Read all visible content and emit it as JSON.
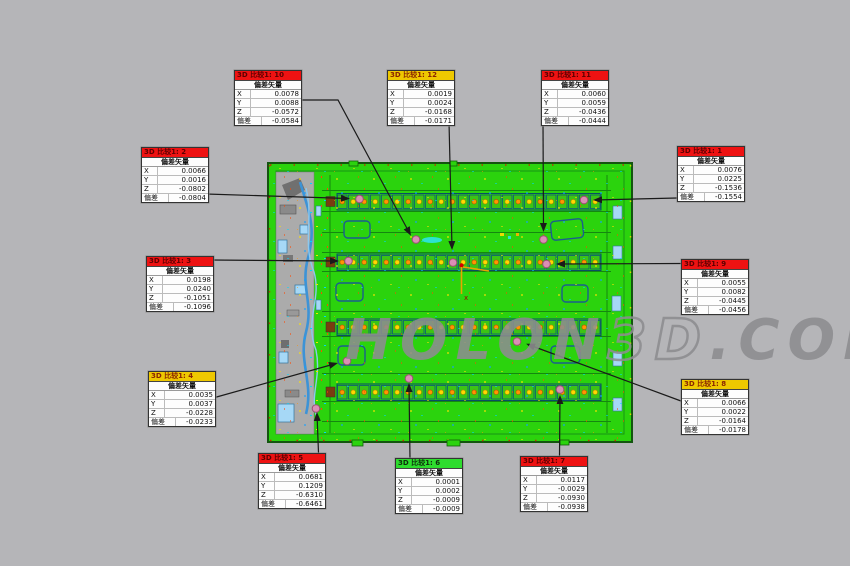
{
  "background": "#b5b5b8",
  "watermark": {
    "part1": "HOLON",
    "part2": "3D",
    "part3": ".COM"
  },
  "labels": {
    "vector_header": "偏差矢量",
    "x": "X",
    "y": "Y",
    "z": "Z",
    "deviation": "偏差"
  },
  "axis": {
    "x_label": "x"
  },
  "colors": {
    "model_green": "#2bd30d",
    "marker_pink": "#da8fb4",
    "fail_red": "#ee1212",
    "warn_yellow": "#eec800",
    "pass_green": "#2edc2e"
  },
  "callouts": [
    {
      "title": "3D 比较1: 10",
      "severity": "red",
      "header_bg": "#ee1212",
      "header_fg": "#5d0000",
      "x": "0.0078",
      "y": "0.0088",
      "z": "-0.0572",
      "deviation": "-0.0584"
    },
    {
      "title": "3D 比较1: 12",
      "severity": "yellow",
      "header_bg": "#eec800",
      "header_fg": "#8a2500",
      "x": "0.0019",
      "y": "0.0024",
      "z": "-0.0168",
      "deviation": "-0.0171"
    },
    {
      "title": "3D 比较1: 11",
      "severity": "red",
      "header_bg": "#ee1212",
      "header_fg": "#5d0000",
      "x": "0.0060",
      "y": "0.0059",
      "z": "-0.0436",
      "deviation": "-0.0444"
    },
    {
      "title": "3D 比较1: 2",
      "severity": "red",
      "header_bg": "#ee1212",
      "header_fg": "#5d0000",
      "x": "0.0066",
      "y": "0.0016",
      "z": "-0.0802",
      "deviation": "-0.0804"
    },
    {
      "title": "3D 比较1: 1",
      "severity": "red",
      "header_bg": "#ee1212",
      "header_fg": "#5d0000",
      "x": "0.0076",
      "y": "0.0225",
      "z": "-0.1536",
      "deviation": "-0.1554"
    },
    {
      "title": "3D 比较1: 3",
      "severity": "red",
      "header_bg": "#ee1212",
      "header_fg": "#5d0000",
      "x": "0.0198",
      "y": "0.0240",
      "z": "-0.1051",
      "deviation": "-0.1096"
    },
    {
      "title": "3D 比较1: 9",
      "severity": "red",
      "header_bg": "#ee1212",
      "header_fg": "#5d0000",
      "x": "0.0055",
      "y": "0.0082",
      "z": "-0.0445",
      "deviation": "-0.0456"
    },
    {
      "title": "3D 比较1: 4",
      "severity": "yellow",
      "header_bg": "#eec800",
      "header_fg": "#8a2500",
      "x": "0.0035",
      "y": "0.0037",
      "z": "-0.0228",
      "deviation": "-0.0233"
    },
    {
      "title": "3D 比较1: 8",
      "severity": "yellow",
      "header_bg": "#eec800",
      "header_fg": "#8a2500",
      "x": "0.0066",
      "y": "0.0022",
      "z": "-0.0164",
      "deviation": "-0.0178"
    },
    {
      "title": "3D 比较1: 5",
      "severity": "red",
      "header_bg": "#ee1212",
      "header_fg": "#5d0000",
      "x": "0.0681",
      "y": "0.1209",
      "z": "-0.6310",
      "deviation": "-0.6461"
    },
    {
      "title": "3D 比较1: 6",
      "severity": "green",
      "header_bg": "#2edc2e",
      "header_fg": "#0d2e0d",
      "x": "0.0001",
      "y": "0.0002",
      "z": "-0.0009",
      "deviation": "-0.0009"
    },
    {
      "title": "3D 比较1: 7",
      "severity": "red",
      "header_bg": "#ee1212",
      "header_fg": "#5d0000",
      "x": "0.0117",
      "y": "-0.0029",
      "z": "-0.0930",
      "deviation": "-0.0938"
    }
  ]
}
